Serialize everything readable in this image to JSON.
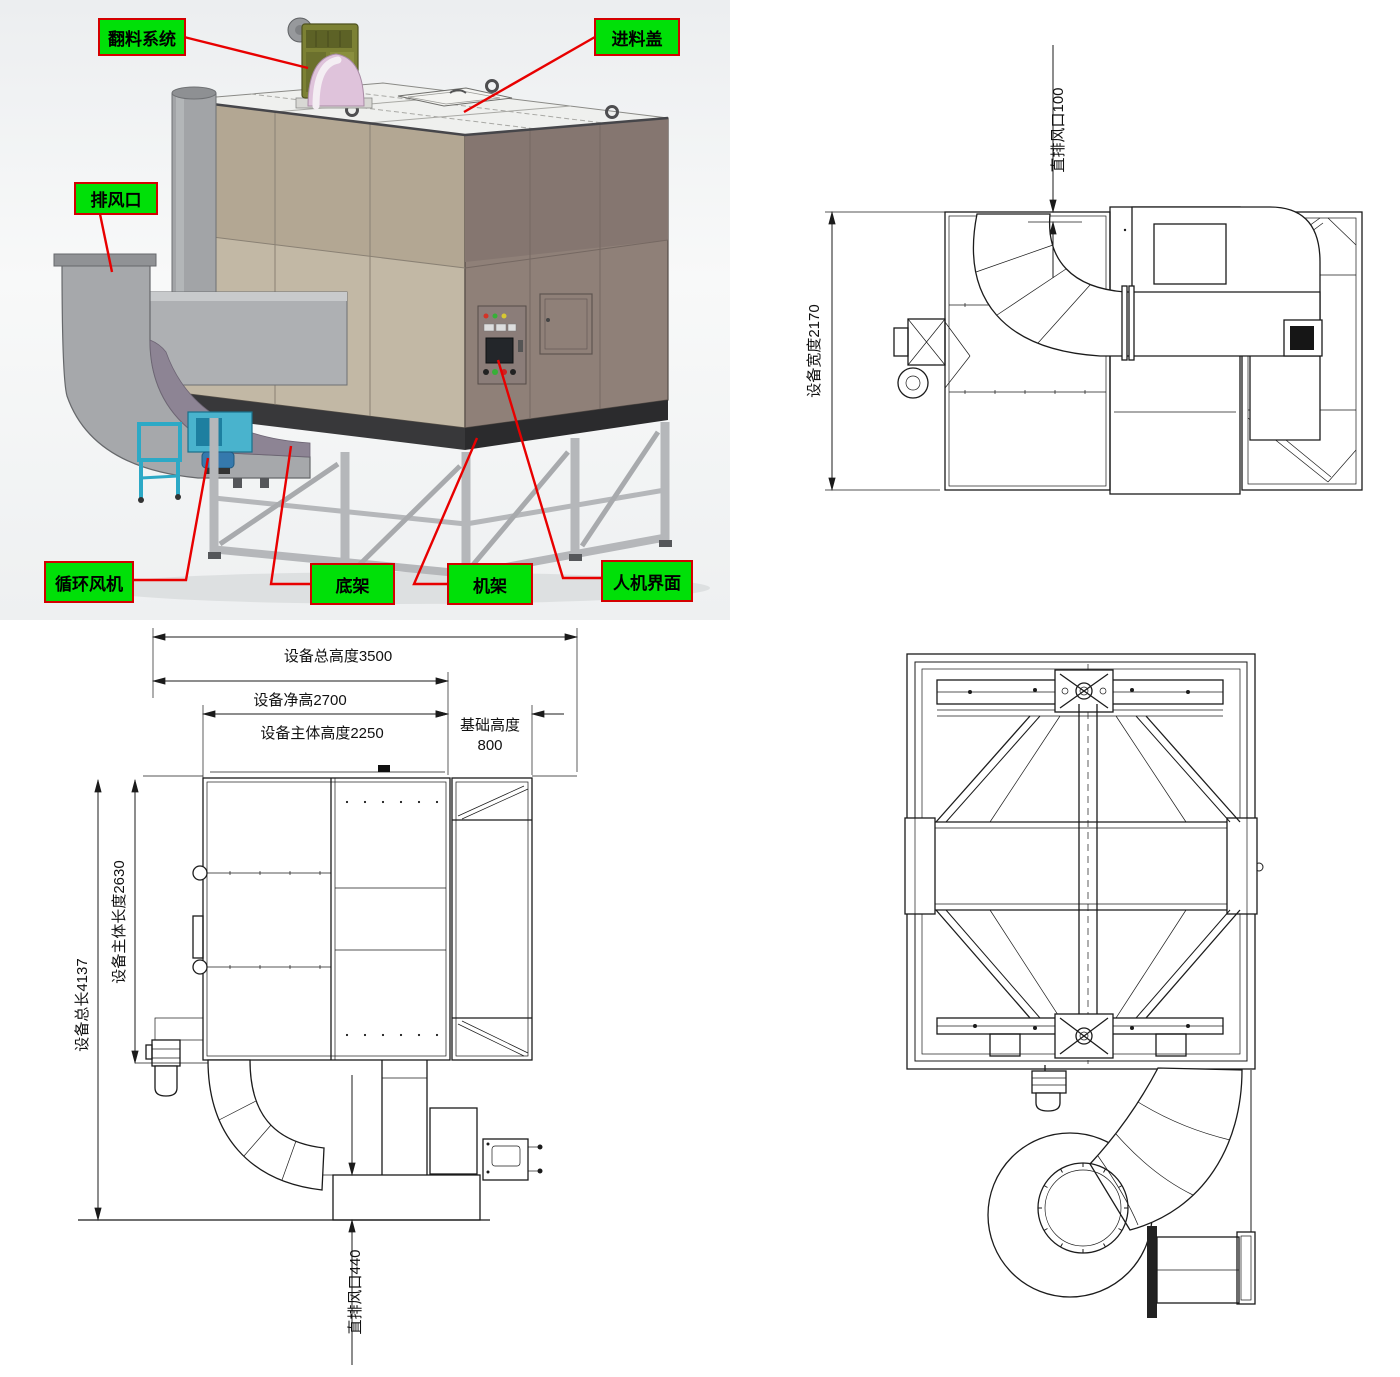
{
  "colors": {
    "label_bg": "#00e008",
    "label_border": "#d40000",
    "leader_line": "#e80000",
    "cad_line": "#1b1b1b",
    "box_left_face": "#c2b8a5",
    "box_right_face": "#8f8078",
    "fan_blue": "#49b3cd",
    "motor_olive": "#7c8134",
    "dome_pink": "#dfc3db"
  },
  "iso_view": {
    "labels": [
      {
        "id": "flip-system",
        "text": "翻料系统"
      },
      {
        "id": "feed-cover",
        "text": "进料盖"
      },
      {
        "id": "exhaust-outlet",
        "text": "排风口"
      },
      {
        "id": "circulation-fan",
        "text": "循环风机"
      },
      {
        "id": "bottom-frame",
        "text": "底架"
      },
      {
        "id": "machine-frame",
        "text": "机架"
      },
      {
        "id": "hmi",
        "text": "人机界面"
      }
    ]
  },
  "top_view": {
    "dim_outlet": "直排风口100",
    "dim_width": "设备宽度2170"
  },
  "side_view": {
    "dim_total_height": "设备总高度3500",
    "dim_net_height": "设备净高2700",
    "dim_body_height": "设备主体高度2250",
    "dim_foundation_label": "基础高度",
    "dim_foundation_value": "800",
    "dim_total_length": "设备总长4137",
    "dim_body_length": "设备主体长度2630",
    "dim_outlet": "直排风口440"
  }
}
